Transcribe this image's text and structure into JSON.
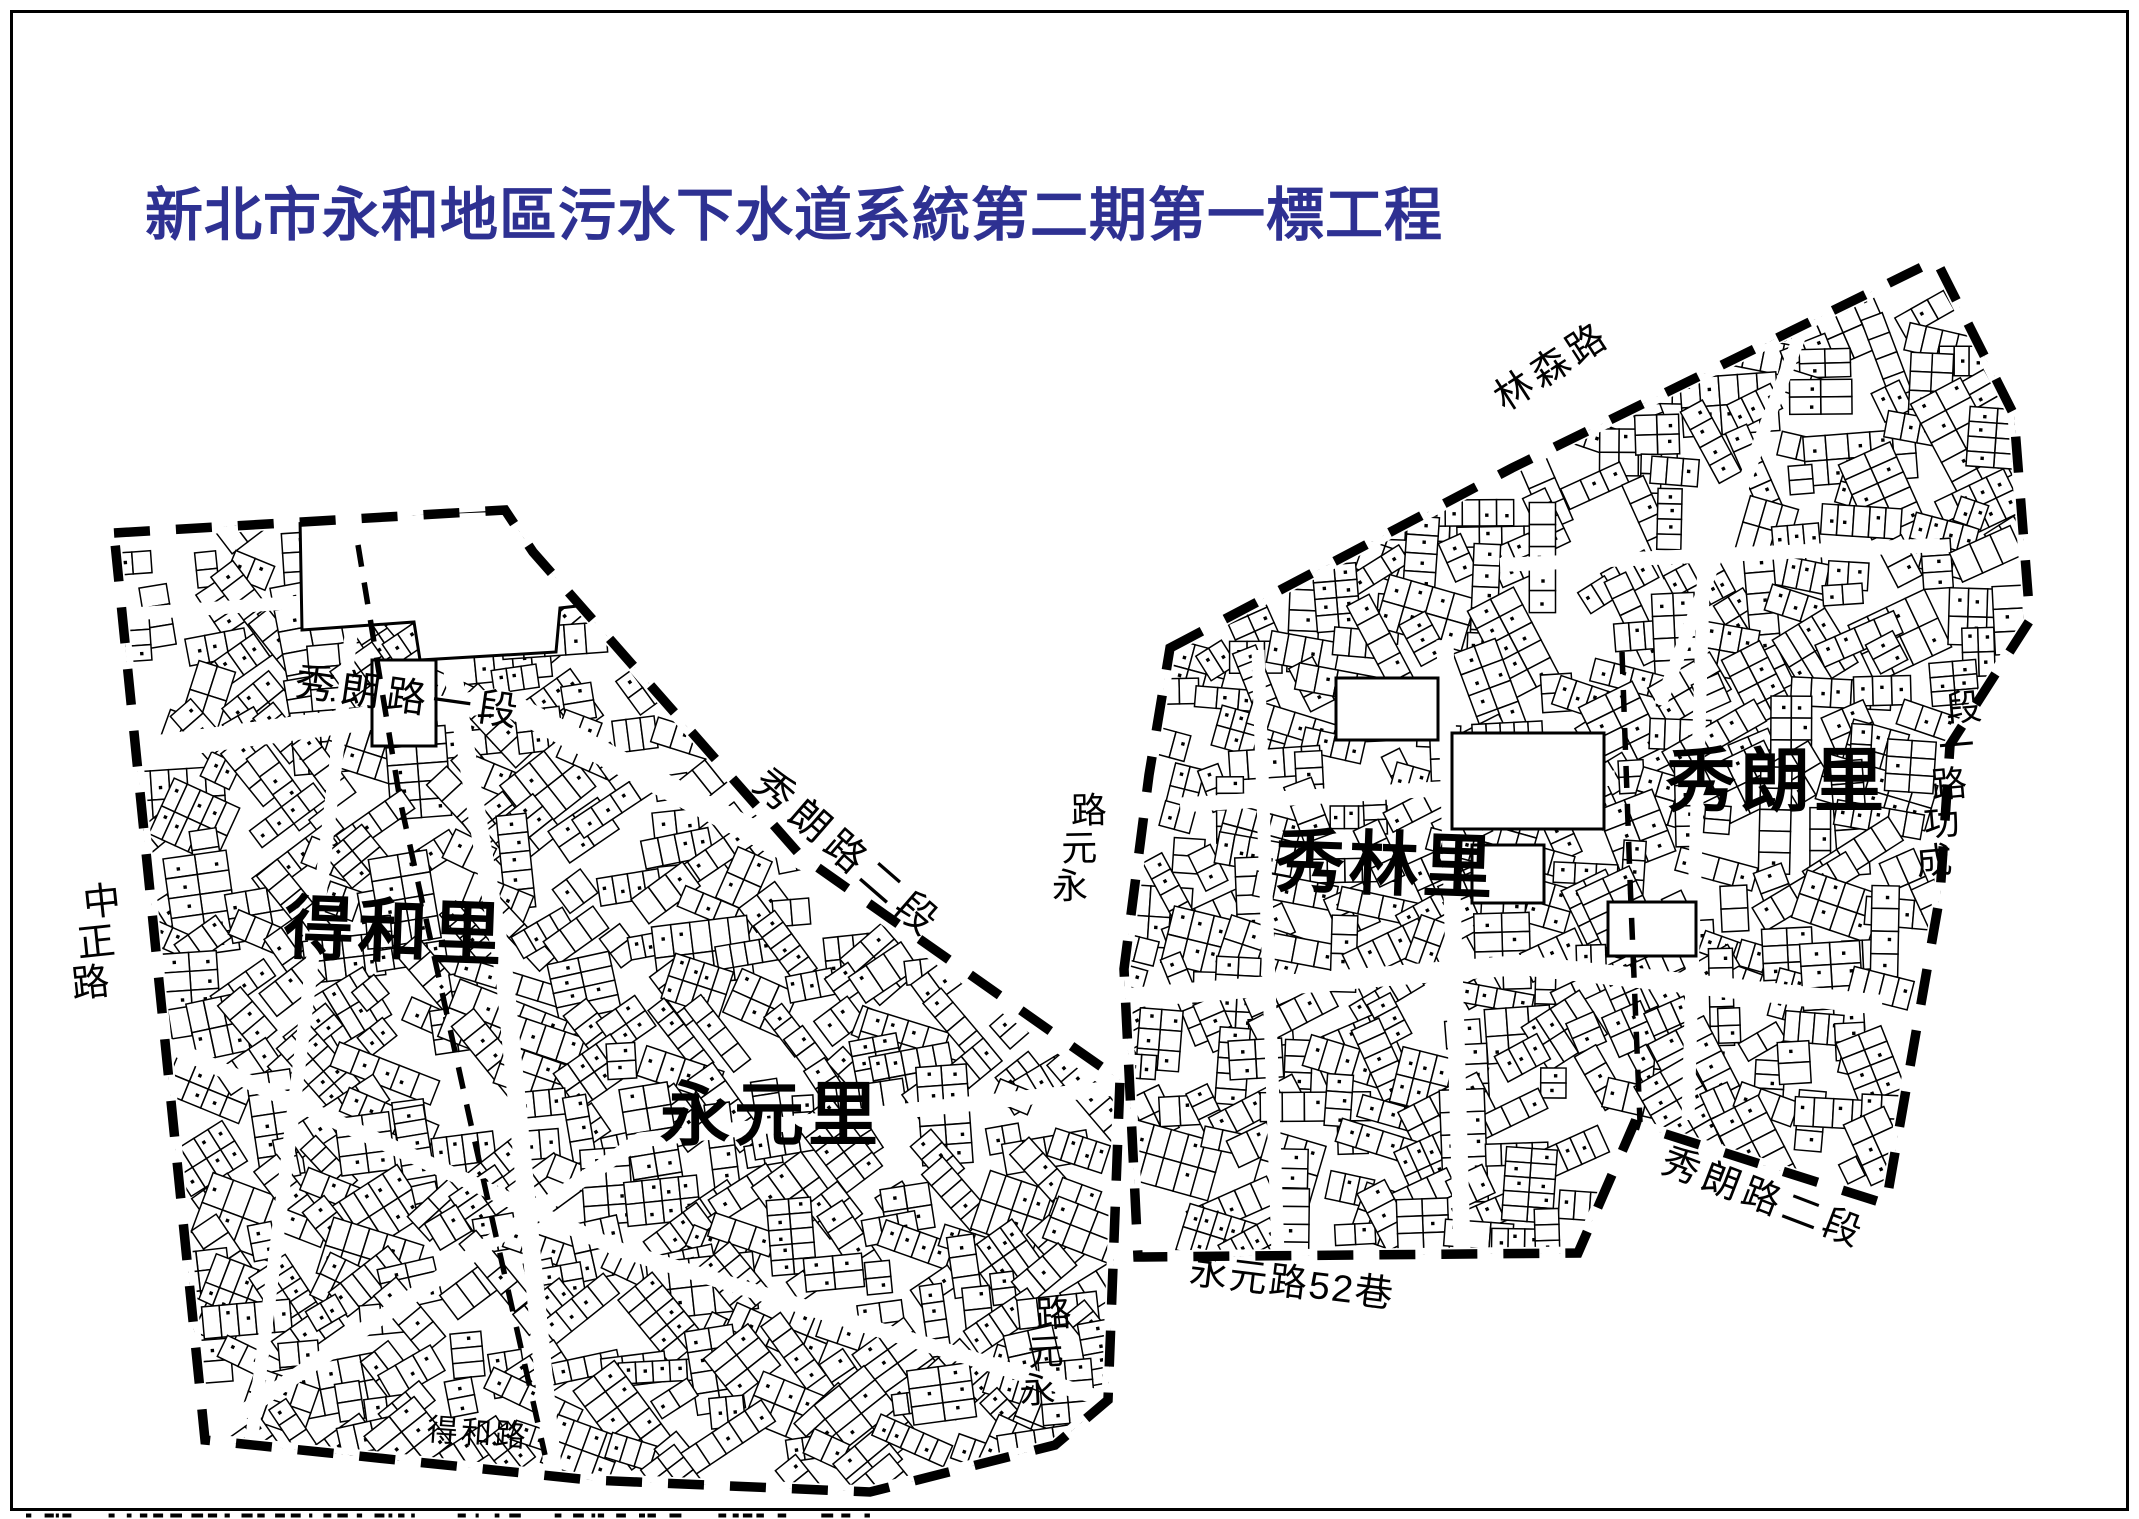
{
  "page": {
    "title": "新北市永和地區污水下水道系統第二期第一標工程",
    "title_color": "#2e3192",
    "background_color": "#ffffff",
    "border_color": "#000000",
    "map_ink_color": "#000000"
  },
  "map": {
    "districts": [
      {
        "id": "district-dehe-li",
        "name": "得和里",
        "x": 285,
        "y": 895,
        "size": 70,
        "rotate": 2
      },
      {
        "id": "district-yongyuan-li",
        "name": "永元里",
        "x": 660,
        "y": 1082,
        "size": 70,
        "rotate": 0
      },
      {
        "id": "district-xiulin-li",
        "name": "秀林里",
        "x": 1276,
        "y": 828,
        "size": 70,
        "rotate": 2
      },
      {
        "id": "district-xiulang-li",
        "name": "秀朗里",
        "x": 1666,
        "y": 748,
        "size": 70,
        "rotate": 0
      }
    ],
    "roads": [
      {
        "id": "road-zhongzheng",
        "name": "中正路",
        "x": 86,
        "y": 880,
        "size": 38,
        "rotate": 8,
        "charRotate": -14,
        "vertical": true,
        "reverse": false
      },
      {
        "id": "road-xiulang-sec1",
        "name": "秀朗路一段",
        "x": 298,
        "y": 662,
        "size": 40,
        "rotate": 8,
        "spacing": 6
      },
      {
        "id": "road-xiulang-sec2-nw",
        "name": "秀朗路二段",
        "x": 772,
        "y": 762,
        "size": 40,
        "rotate": 41,
        "spacing": 7
      },
      {
        "id": "road-linsen",
        "name": "林森路",
        "x": 1488,
        "y": 386,
        "size": 38,
        "rotate": -33,
        "spacing": 5
      },
      {
        "id": "road-yongyuan-north",
        "name": "永元路",
        "x": 1076,
        "y": 788,
        "size": 36,
        "rotate": 14,
        "charRotate": -15,
        "vertical": true,
        "reverse": true
      },
      {
        "id": "road-chenggong-sec1",
        "name": "成功路一段",
        "x": 1950,
        "y": 686,
        "size": 36,
        "rotate": 11,
        "charRotate": -16,
        "vertical": true,
        "reverse": true
      },
      {
        "id": "road-xiulang-sec2-se",
        "name": "秀朗路二段",
        "x": 1670,
        "y": 1142,
        "size": 38,
        "rotate": 21,
        "spacing": 5
      },
      {
        "id": "road-yongyuan-lane52",
        "name": "永元路52巷",
        "x": 1192,
        "y": 1252,
        "size": 38,
        "rotate": 7,
        "spacing": 2
      },
      {
        "id": "road-dehe",
        "name": "得和路",
        "x": 428,
        "y": 1414,
        "size": 31,
        "rotate": 4,
        "spacing": 3
      },
      {
        "id": "road-yongyuan-south",
        "name": "永元路",
        "x": 1040,
        "y": 1292,
        "size": 36,
        "rotate": 12,
        "charRotate": -15,
        "vertical": true,
        "reverse": true
      }
    ]
  }
}
